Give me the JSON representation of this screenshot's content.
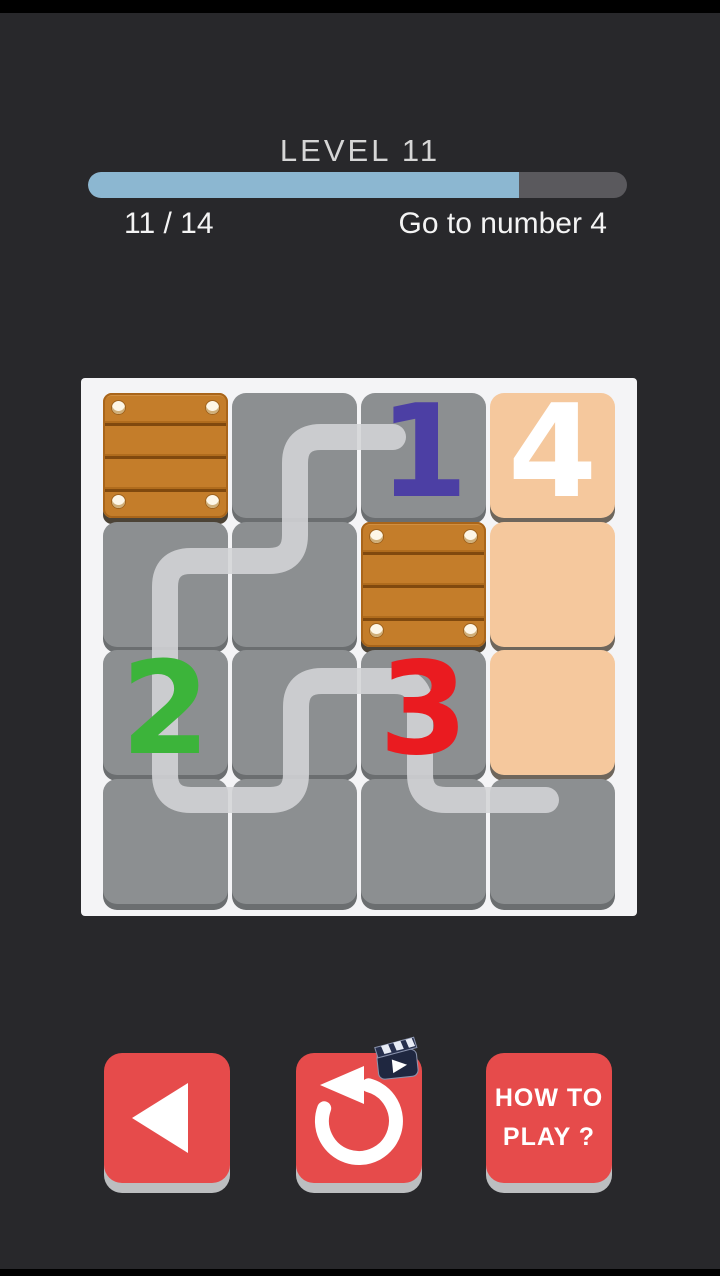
{
  "screen": {
    "background_color": "#28282b"
  },
  "header": {
    "level_label": "LEVEL 11",
    "progress_percent": 80,
    "progress_text": "11 / 14",
    "goal_text": "Go to number 4",
    "progress_fill_color": "#8cb7d1",
    "progress_track_color": "#5a595d"
  },
  "board": {
    "rows": 4,
    "cols": 4,
    "cell_gray_color": "#8c8f91",
    "cell_peach_color": "#f5c89d",
    "crate_color": "#c47d2a",
    "cells": [
      {
        "r": 1,
        "c": 1,
        "type": "crate"
      },
      {
        "r": 1,
        "c": 2,
        "type": "plain",
        "bg": "gray"
      },
      {
        "r": 1,
        "c": 3,
        "type": "number",
        "value": "1",
        "number_color": "#4c3fa4",
        "bg": "gray"
      },
      {
        "r": 1,
        "c": 4,
        "type": "number",
        "value": "4",
        "number_color": "#ffffff",
        "bg": "peach"
      },
      {
        "r": 2,
        "c": 1,
        "type": "plain",
        "bg": "gray"
      },
      {
        "r": 2,
        "c": 2,
        "type": "plain",
        "bg": "gray"
      },
      {
        "r": 2,
        "c": 3,
        "type": "crate"
      },
      {
        "r": 2,
        "c": 4,
        "type": "plain",
        "bg": "peach"
      },
      {
        "r": 3,
        "c": 1,
        "type": "number",
        "value": "2",
        "number_color": "#3cb43a",
        "bg": "gray"
      },
      {
        "r": 3,
        "c": 2,
        "type": "plain",
        "bg": "gray"
      },
      {
        "r": 3,
        "c": 3,
        "type": "number",
        "value": "3",
        "number_color": "#ea1b20",
        "bg": "gray"
      },
      {
        "r": 3,
        "c": 4,
        "type": "plain",
        "bg": "peach"
      },
      {
        "r": 4,
        "c": 1,
        "type": "plain",
        "bg": "gray"
      },
      {
        "r": 4,
        "c": 2,
        "type": "plain",
        "bg": "gray"
      },
      {
        "r": 4,
        "c": 3,
        "type": "plain",
        "bg": "gray"
      },
      {
        "r": 4,
        "c": 4,
        "type": "plain",
        "bg": "gray"
      }
    ],
    "drawn_path": {
      "color": "#d4d5d7",
      "width": 26,
      "opacity": 0.88,
      "corner_radius": 26,
      "points": [
        [
          312,
          59
        ],
        [
          214,
          59
        ],
        [
          214,
          183
        ],
        [
          84,
          183
        ],
        [
          84,
          422
        ],
        [
          215,
          422
        ],
        [
          215,
          303
        ],
        [
          339,
          303
        ],
        [
          339,
          422
        ],
        [
          465,
          422
        ]
      ]
    }
  },
  "footer": {
    "button_color": "#e64b4b",
    "back_button": {
      "icon": "back-arrow"
    },
    "restart_button": {
      "icon": "restart-arrow",
      "badge_icon": "video-clapper"
    },
    "help_button": {
      "line1": "HOW TO",
      "line2": "PLAY ?"
    }
  }
}
